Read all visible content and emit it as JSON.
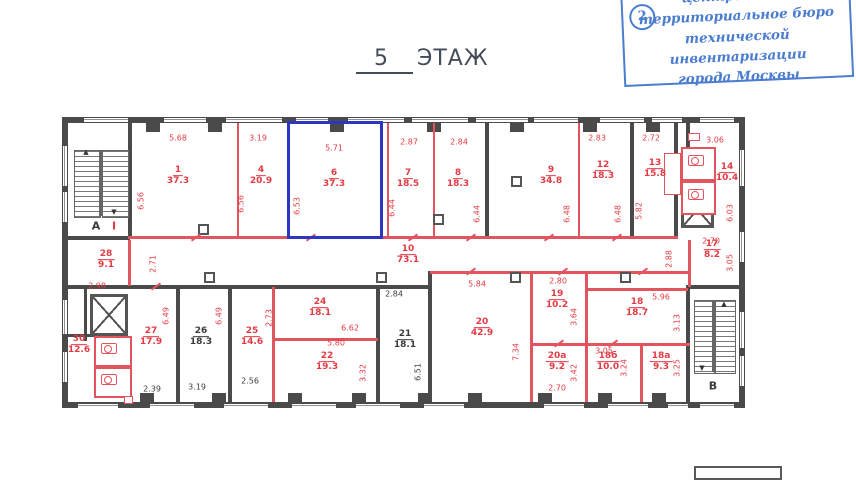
{
  "stamp": {
    "number": "2",
    "lines": [
      "центральное",
      "территориальное бюро",
      "технической инвентаризации",
      "города Москвы"
    ]
  },
  "title": {
    "number": "5",
    "label": "ЭТАЖ"
  },
  "colors": {
    "red": "#e23b44",
    "black": "#3a3a3a",
    "blue": "#2d36c0",
    "stamp_blue": "#4a7cd0",
    "wall_gray": "#4a4a4a"
  },
  "plan": {
    "rooms": [
      {
        "num": "1",
        "area": "37.3",
        "x": 178,
        "y": 176
      },
      {
        "num": "4",
        "area": "20.9",
        "x": 261,
        "y": 176
      },
      {
        "num": "6",
        "area": "37.3",
        "x": 334,
        "y": 179
      },
      {
        "num": "7",
        "area": "18.5",
        "x": 408,
        "y": 179
      },
      {
        "num": "8",
        "area": "18.3",
        "x": 458,
        "y": 179
      },
      {
        "num": "9",
        "area": "34.8",
        "x": 551,
        "y": 176
      },
      {
        "num": "12",
        "area": "18.3",
        "x": 603,
        "y": 171
      },
      {
        "num": "13",
        "area": "15.8",
        "x": 655,
        "y": 169
      },
      {
        "num": "14",
        "area": "10.4",
        "x": 727,
        "y": 173
      },
      {
        "num": "10",
        "area": "73.1",
        "x": 408,
        "y": 255
      },
      {
        "num": "28",
        "area": "9.1",
        "x": 106,
        "y": 260
      },
      {
        "num": "17",
        "area": "8.2",
        "x": 712,
        "y": 250
      },
      {
        "num": "30",
        "area": "12.6",
        "x": 79,
        "y": 345
      },
      {
        "num": "27",
        "area": "17.9",
        "x": 151,
        "y": 337
      },
      {
        "num": "26",
        "area": "18.3",
        "x": 201,
        "y": 337,
        "c": "b"
      },
      {
        "num": "25",
        "area": "14.6",
        "x": 252,
        "y": 337
      },
      {
        "num": "24",
        "area": "18.1",
        "x": 320,
        "y": 308
      },
      {
        "num": "22",
        "area": "19.3",
        "x": 327,
        "y": 362
      },
      {
        "num": "21",
        "area": "18.1",
        "x": 405,
        "y": 340,
        "c": "b"
      },
      {
        "num": "20",
        "area": "42.9",
        "x": 482,
        "y": 328
      },
      {
        "num": "19",
        "area": "10.2",
        "x": 557,
        "y": 300
      },
      {
        "num": "20а",
        "area": "9.2",
        "x": 557,
        "y": 362
      },
      {
        "num": "18",
        "area": "18.7",
        "x": 637,
        "y": 308
      },
      {
        "num": "18б",
        "area": "10.0",
        "x": 608,
        "y": 362
      },
      {
        "num": "18а",
        "area": "9.3",
        "x": 661,
        "y": 362
      }
    ],
    "dims": [
      {
        "v": "5.68",
        "x": 178,
        "y": 138
      },
      {
        "v": "3.19",
        "x": 258,
        "y": 138
      },
      {
        "v": "5.71",
        "x": 334,
        "y": 148
      },
      {
        "v": "2.87",
        "x": 409,
        "y": 142
      },
      {
        "v": "2.84",
        "x": 459,
        "y": 142
      },
      {
        "v": "2.83",
        "x": 597,
        "y": 138
      },
      {
        "v": "2.72",
        "x": 651,
        "y": 138
      },
      {
        "v": "3.06",
        "x": 715,
        "y": 140
      },
      {
        "v": "6.56",
        "x": 141,
        "y": 201,
        "rot": 1
      },
      {
        "v": "6.56",
        "x": 241,
        "y": 204,
        "rot": 1
      },
      {
        "v": "6.53",
        "x": 297,
        "y": 206,
        "rot": 1
      },
      {
        "v": "6.44",
        "x": 392,
        "y": 208,
        "rot": 1
      },
      {
        "v": "6.44",
        "x": 477,
        "y": 214,
        "rot": 1
      },
      {
        "v": "6.48",
        "x": 567,
        "y": 214,
        "rot": 1
      },
      {
        "v": "6.48",
        "x": 618,
        "y": 214,
        "rot": 1
      },
      {
        "v": "5.82",
        "x": 639,
        "y": 211,
        "rot": 1
      },
      {
        "v": "6.03",
        "x": 730,
        "y": 213,
        "rot": 1
      },
      {
        "v": "2.71",
        "x": 153,
        "y": 264,
        "rot": 1
      },
      {
        "v": "2.98",
        "x": 97,
        "y": 286
      },
      {
        "v": "2.88",
        "x": 669,
        "y": 259,
        "rot": 1
      },
      {
        "v": "2.70",
        "x": 711,
        "y": 241
      },
      {
        "v": "3.05",
        "x": 730,
        "y": 263,
        "rot": 1
      },
      {
        "v": "6.49",
        "x": 166,
        "y": 316,
        "rot": 1
      },
      {
        "v": "6.49",
        "x": 219,
        "y": 316,
        "rot": 1
      },
      {
        "v": "2.73",
        "x": 269,
        "y": 318,
        "rot": 1
      },
      {
        "v": "6.62",
        "x": 350,
        "y": 328
      },
      {
        "v": "5.80",
        "x": 336,
        "y": 343
      },
      {
        "v": "3.32",
        "x": 363,
        "y": 373,
        "rot": 1
      },
      {
        "v": "6.51",
        "x": 418,
        "y": 372,
        "rot": 1,
        "c": "b"
      },
      {
        "v": "2.84",
        "x": 394,
        "y": 294,
        "c": "b"
      },
      {
        "v": "2.39",
        "x": 152,
        "y": 389,
        "c": "b"
      },
      {
        "v": "3.19",
        "x": 197,
        "y": 387,
        "c": "b"
      },
      {
        "v": "2.56",
        "x": 250,
        "y": 381,
        "c": "b"
      },
      {
        "v": "5.84",
        "x": 477,
        "y": 284
      },
      {
        "v": "7.34",
        "x": 516,
        "y": 352,
        "rot": 1
      },
      {
        "v": "2.80",
        "x": 558,
        "y": 281
      },
      {
        "v": "3.64",
        "x": 574,
        "y": 317,
        "rot": 1
      },
      {
        "v": "2.70",
        "x": 557,
        "y": 388
      },
      {
        "v": "3.42",
        "x": 574,
        "y": 373,
        "rot": 1
      },
      {
        "v": "3.05",
        "x": 604,
        "y": 351
      },
      {
        "v": "3.24",
        "x": 624,
        "y": 368,
        "rot": 1
      },
      {
        "v": "3.25",
        "x": 677,
        "y": 368,
        "rot": 1
      },
      {
        "v": "5.96",
        "x": 661,
        "y": 297
      },
      {
        "v": "3.13",
        "x": 677,
        "y": 323,
        "rot": 1
      }
    ],
    "letters": [
      {
        "t": "А",
        "x": 96,
        "y": 226,
        "c": "b"
      },
      {
        "t": "I",
        "x": 114,
        "y": 226
      },
      {
        "t": "В",
        "x": 713,
        "y": 386,
        "c": "b"
      }
    ]
  }
}
